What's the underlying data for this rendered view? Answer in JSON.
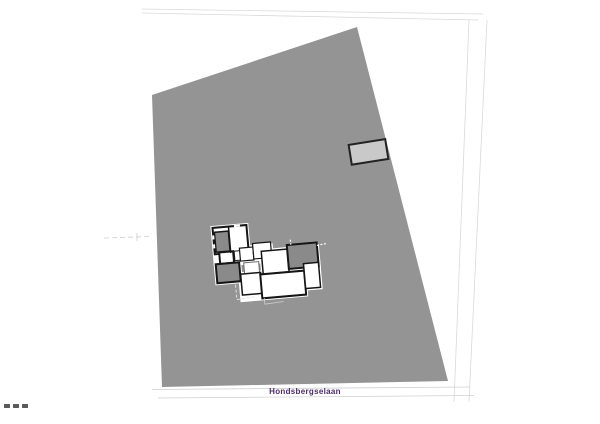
{
  "plan": {
    "street_label": "Hondsbergselaan"
  },
  "colors": {
    "background": "#ffffff",
    "parcel_fill": "#949494",
    "dark_room_fill": "#8a8a8a",
    "room_fill": "#ffffff",
    "wall_stroke": "#161616",
    "garage_fill": "#c9c9c9",
    "garage_stroke": "#222222",
    "street_label_text": "#4b2a66",
    "faint_boundary_line": "#d9d9d9",
    "street_edge_line": "#d0d0d0",
    "scale_mark_fill": "#5a5a5a"
  }
}
